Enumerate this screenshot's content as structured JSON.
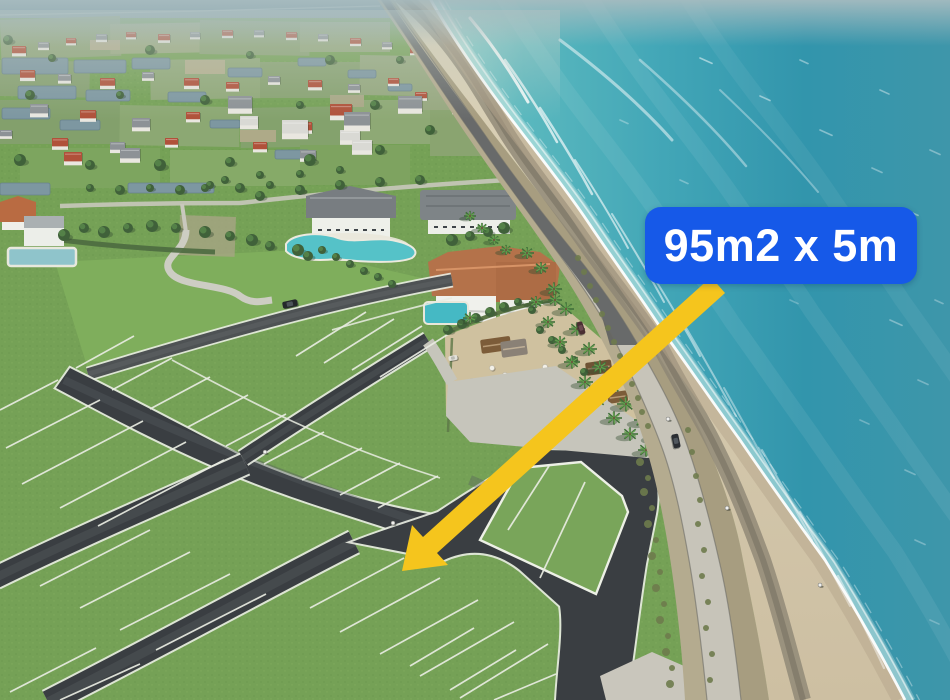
{
  "annotation": {
    "label": "95m2 x 5m",
    "badge_color": "#1659e8",
    "label_color": "#ffffff",
    "arrow_color": "#f5c51d"
  },
  "photo": {
    "ocean_color": "#3ea5b6",
    "shallow_water_color": "#8fd0cc",
    "sand_color": "#d6cbb0",
    "grass_color": "#76a156",
    "asphalt_road_color": "#3a3e42",
    "plot_line_color": "#e9ece2",
    "concrete_road_color": "#c7c4b9"
  }
}
